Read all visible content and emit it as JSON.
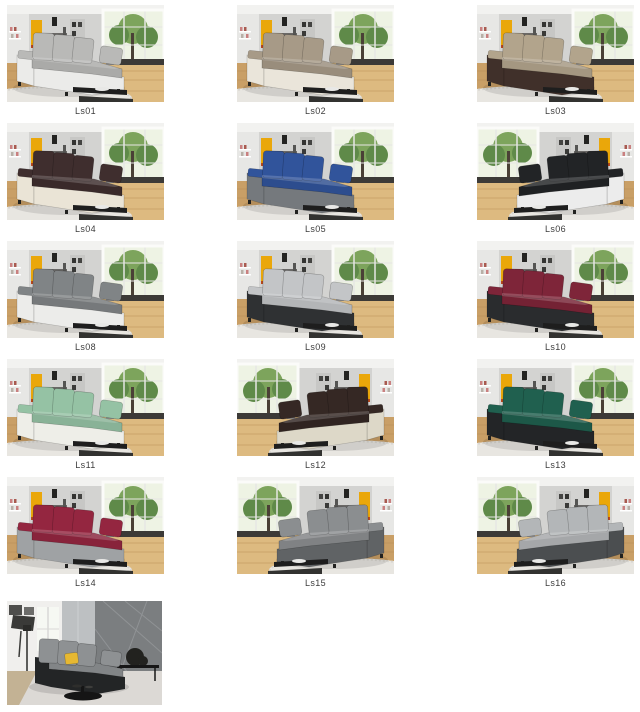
{
  "page": {
    "background": "#ffffff"
  },
  "gallery": {
    "caption_color": "#3c3c3c",
    "items": [
      {
        "id": "ls01",
        "label": "Ls01",
        "scene": "living",
        "mirrored": false,
        "colors": {
          "cushion": "#b9b9b7",
          "base": "#ebebe9"
        }
      },
      {
        "id": "ls02",
        "label": "Ls02",
        "scene": "living",
        "mirrored": false,
        "colors": {
          "cushion": "#a79a87",
          "base": "#eae5da"
        }
      },
      {
        "id": "ls03",
        "label": "Ls03",
        "scene": "living",
        "mirrored": false,
        "colors": {
          "cushion": "#b2a48c",
          "base": "#40302a"
        }
      },
      {
        "id": "ls04",
        "label": "Ls04",
        "scene": "living",
        "mirrored": false,
        "colors": {
          "cushion": "#3f2e2e",
          "base": "#eae4d6"
        }
      },
      {
        "id": "ls05",
        "label": "Ls05",
        "scene": "living",
        "mirrored": false,
        "colors": {
          "cushion": "#31549b",
          "base": "#75797d"
        }
      },
      {
        "id": "ls06",
        "label": "Ls06",
        "scene": "living",
        "mirrored": true,
        "colors": {
          "cushion": "#222426",
          "base": "#ececec"
        }
      },
      {
        "id": "ls08",
        "label": "Ls08",
        "scene": "living",
        "mirrored": false,
        "colors": {
          "cushion": "#808486",
          "base": "#ececea"
        }
      },
      {
        "id": "ls09",
        "label": "Ls09",
        "scene": "living",
        "mirrored": false,
        "colors": {
          "cushion": "#c3c5c7",
          "base": "#2f3133"
        }
      },
      {
        "id": "ls10",
        "label": "Ls10",
        "scene": "living",
        "mirrored": false,
        "colors": {
          "cushion": "#7e2539",
          "base": "#2a2c2e"
        }
      },
      {
        "id": "ls11",
        "label": "Ls11",
        "scene": "living",
        "mirrored": false,
        "colors": {
          "cushion": "#95c2a4",
          "base": "#eeeee8"
        }
      },
      {
        "id": "ls12",
        "label": "Ls12",
        "scene": "living",
        "mirrored": true,
        "colors": {
          "cushion": "#352824",
          "base": "#ddd8c8"
        }
      },
      {
        "id": "ls13",
        "label": "Ls13",
        "scene": "living",
        "mirrored": false,
        "colors": {
          "cushion": "#20604f",
          "base": "#232527"
        }
      },
      {
        "id": "ls14",
        "label": "Ls14",
        "scene": "living",
        "mirrored": false,
        "colors": {
          "cushion": "#942640",
          "base": "#9fa2a4"
        }
      },
      {
        "id": "ls15",
        "label": "Ls15",
        "scene": "living",
        "mirrored": true,
        "colors": {
          "cushion": "#8b8e90",
          "base": "#606365"
        }
      },
      {
        "id": "ls16",
        "label": "Ls16",
        "scene": "living",
        "mirrored": true,
        "colors": {
          "cushion": "#b3b6b8",
          "base": "#4b4e50"
        }
      },
      {
        "id": "modern",
        "label": "",
        "scene": "modern",
        "mirrored": false,
        "colors": {
          "cushion": "#8e9193",
          "base": "#232526",
          "pillow": "#e6b832"
        }
      }
    ],
    "living_palette": {
      "wall": "#d3d3d1",
      "ceiling": "#f2f2f0",
      "left_wall": "#e7e7e5",
      "accent_yellow": "#eaa70a",
      "accent_red": "#b8481e",
      "window_sky": "#eef3e4",
      "foliage": "#7da45c",
      "foliage_dark": "#5f8a49",
      "trunk": "#4a4036",
      "window_frame": "#fbfbf9",
      "mullion": "#e6e6e4",
      "shelf_item_pink": "#c98080",
      "shelf_item_red": "#a85a50",
      "shelf_item_gray": "#b8b0a8",
      "dark_furniture": "#242422",
      "shelf_unit": "#c7c7c5",
      "counter": "#8e8c8a",
      "counter_top": "#6a6866",
      "floor": "#c99f66",
      "floor_light": "#ddba80",
      "plank": "#b78e55",
      "rug": "#e8e6e1",
      "rug_edge": "#d9d6d0",
      "table": "#1e1e1e",
      "table_lower": "#323230",
      "bench": "#3c3a37",
      "bowl": "#e8e8e6"
    },
    "modern_palette": {
      "wall_left": "#f0efed",
      "wall_right": "#7b7e80",
      "wall_lines": "#909395",
      "center_panel": "#bdc0c2",
      "window": "#f6f8f3",
      "window_frame": "#d9d9d7",
      "frame_dark": "#4e4e4c",
      "frame_light": "#6c6c6a",
      "easel": "#3a3a38",
      "lamp": "#2b2b29",
      "floor_rug": "#dcd9d5",
      "wood": "#c3b294",
      "console": "#161616",
      "plant": "#22221f",
      "table": "#151515"
    }
  }
}
